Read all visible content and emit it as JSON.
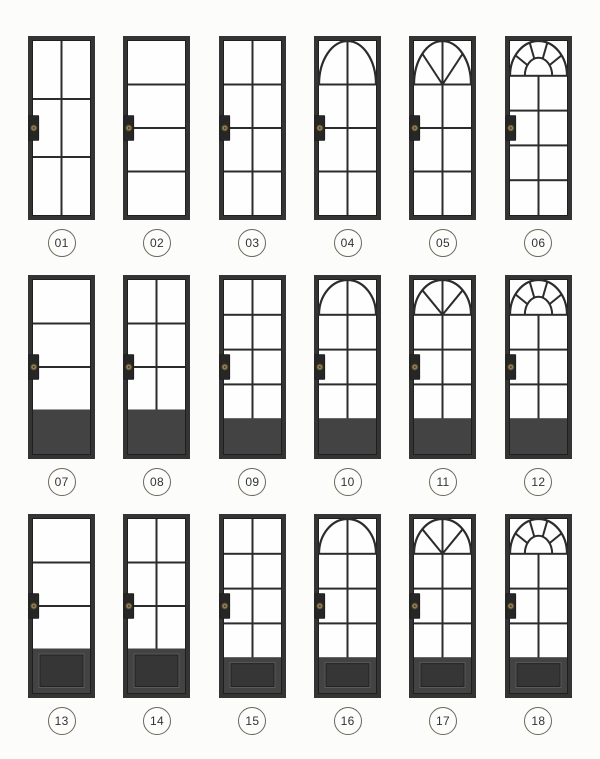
{
  "page": {
    "title": "Steel door style catalog",
    "background_color": "#fcfcfa"
  },
  "style": {
    "frame_color": "#343434",
    "frame_inner_edge_color": "#1f1f1f",
    "muntin_color": "#2c2c2c",
    "glass_color": "#fefefe",
    "panel_color": "#434343",
    "raised_panel_color": "#363636",
    "raised_panel_highlight": "#5a5a5a",
    "handle_plate_color": "#262626",
    "handle_knob_color": "#8d7c50",
    "handle_knob_ring": "#473c28",
    "badge_border_color": "#6e6757",
    "badge_text_color": "#333333"
  },
  "catalog": {
    "grid": {
      "columns": 6,
      "rows": 3
    },
    "doors": [
      {
        "number": "01",
        "top": "flat",
        "columns": 2,
        "glass_rows": 3,
        "bottom": "glass"
      },
      {
        "number": "02",
        "top": "flat",
        "columns": 1,
        "glass_rows": 4,
        "bottom": "glass"
      },
      {
        "number": "03",
        "top": "flat",
        "columns": 2,
        "glass_rows": 4,
        "bottom": "glass"
      },
      {
        "number": "04",
        "top": "arch",
        "columns": 2,
        "glass_rows": 3,
        "bottom": "glass"
      },
      {
        "number": "05",
        "top": "fan",
        "columns": 2,
        "glass_rows": 3,
        "bottom": "glass"
      },
      {
        "number": "06",
        "top": "fan-hub",
        "columns": 2,
        "glass_rows": 4,
        "bottom": "glass"
      },
      {
        "number": "07",
        "top": "flat",
        "columns": 1,
        "glass_rows": 3,
        "bottom": "panel"
      },
      {
        "number": "08",
        "top": "flat",
        "columns": 2,
        "glass_rows": 3,
        "bottom": "panel"
      },
      {
        "number": "09",
        "top": "flat",
        "columns": 2,
        "glass_rows": 4,
        "bottom": "panel"
      },
      {
        "number": "10",
        "top": "arch",
        "columns": 2,
        "glass_rows": 3,
        "bottom": "panel"
      },
      {
        "number": "11",
        "top": "fan",
        "columns": 2,
        "glass_rows": 3,
        "bottom": "panel"
      },
      {
        "number": "12",
        "top": "fan-hub",
        "columns": 2,
        "glass_rows": 3,
        "bottom": "panel"
      },
      {
        "number": "13",
        "top": "flat",
        "columns": 1,
        "glass_rows": 3,
        "bottom": "raised-panel"
      },
      {
        "number": "14",
        "top": "flat",
        "columns": 2,
        "glass_rows": 3,
        "bottom": "raised-panel"
      },
      {
        "number": "15",
        "top": "flat",
        "columns": 2,
        "glass_rows": 4,
        "bottom": "raised-panel"
      },
      {
        "number": "16",
        "top": "arch",
        "columns": 2,
        "glass_rows": 3,
        "bottom": "raised-panel"
      },
      {
        "number": "17",
        "top": "fan",
        "columns": 2,
        "glass_rows": 3,
        "bottom": "raised-panel"
      },
      {
        "number": "18",
        "top": "fan-hub",
        "columns": 2,
        "glass_rows": 3,
        "bottom": "raised-panel"
      }
    ]
  }
}
